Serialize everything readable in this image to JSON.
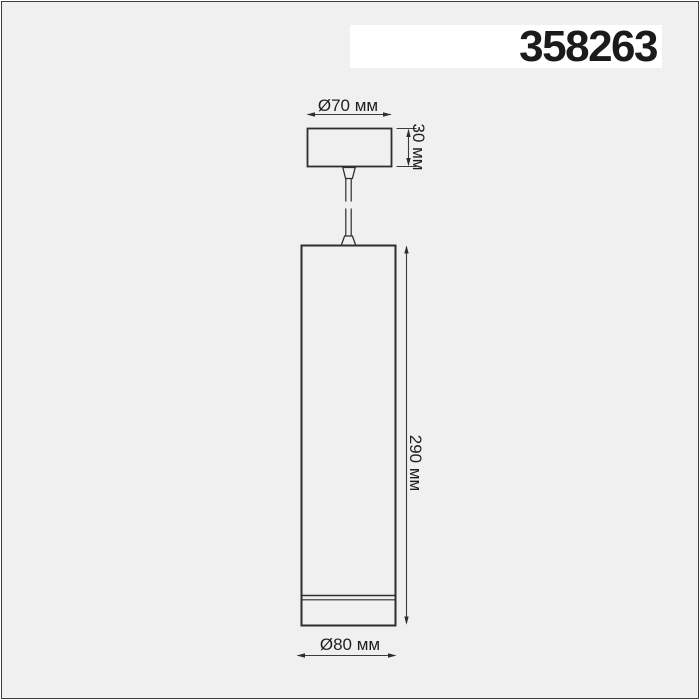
{
  "product": {
    "code": "358263"
  },
  "diagram": {
    "labels": {
      "canopy_diameter": "Ø70 мм",
      "canopy_height": "30 мм",
      "body_height": "290 мм",
      "body_diameter": "Ø80 мм"
    },
    "dimensions_mm": {
      "canopy_diameter": 70,
      "canopy_height": 30,
      "body_height": 290,
      "body_diameter": 80
    }
  },
  "colors": {
    "page": "#ffffff",
    "background": "#f0f0f0",
    "panel": "#ffffff",
    "outline": "#2e2e2e",
    "dimension_line": "#3c3c3c",
    "text": "#1b1b1b",
    "frame_border": "#3d3d3d"
  }
}
